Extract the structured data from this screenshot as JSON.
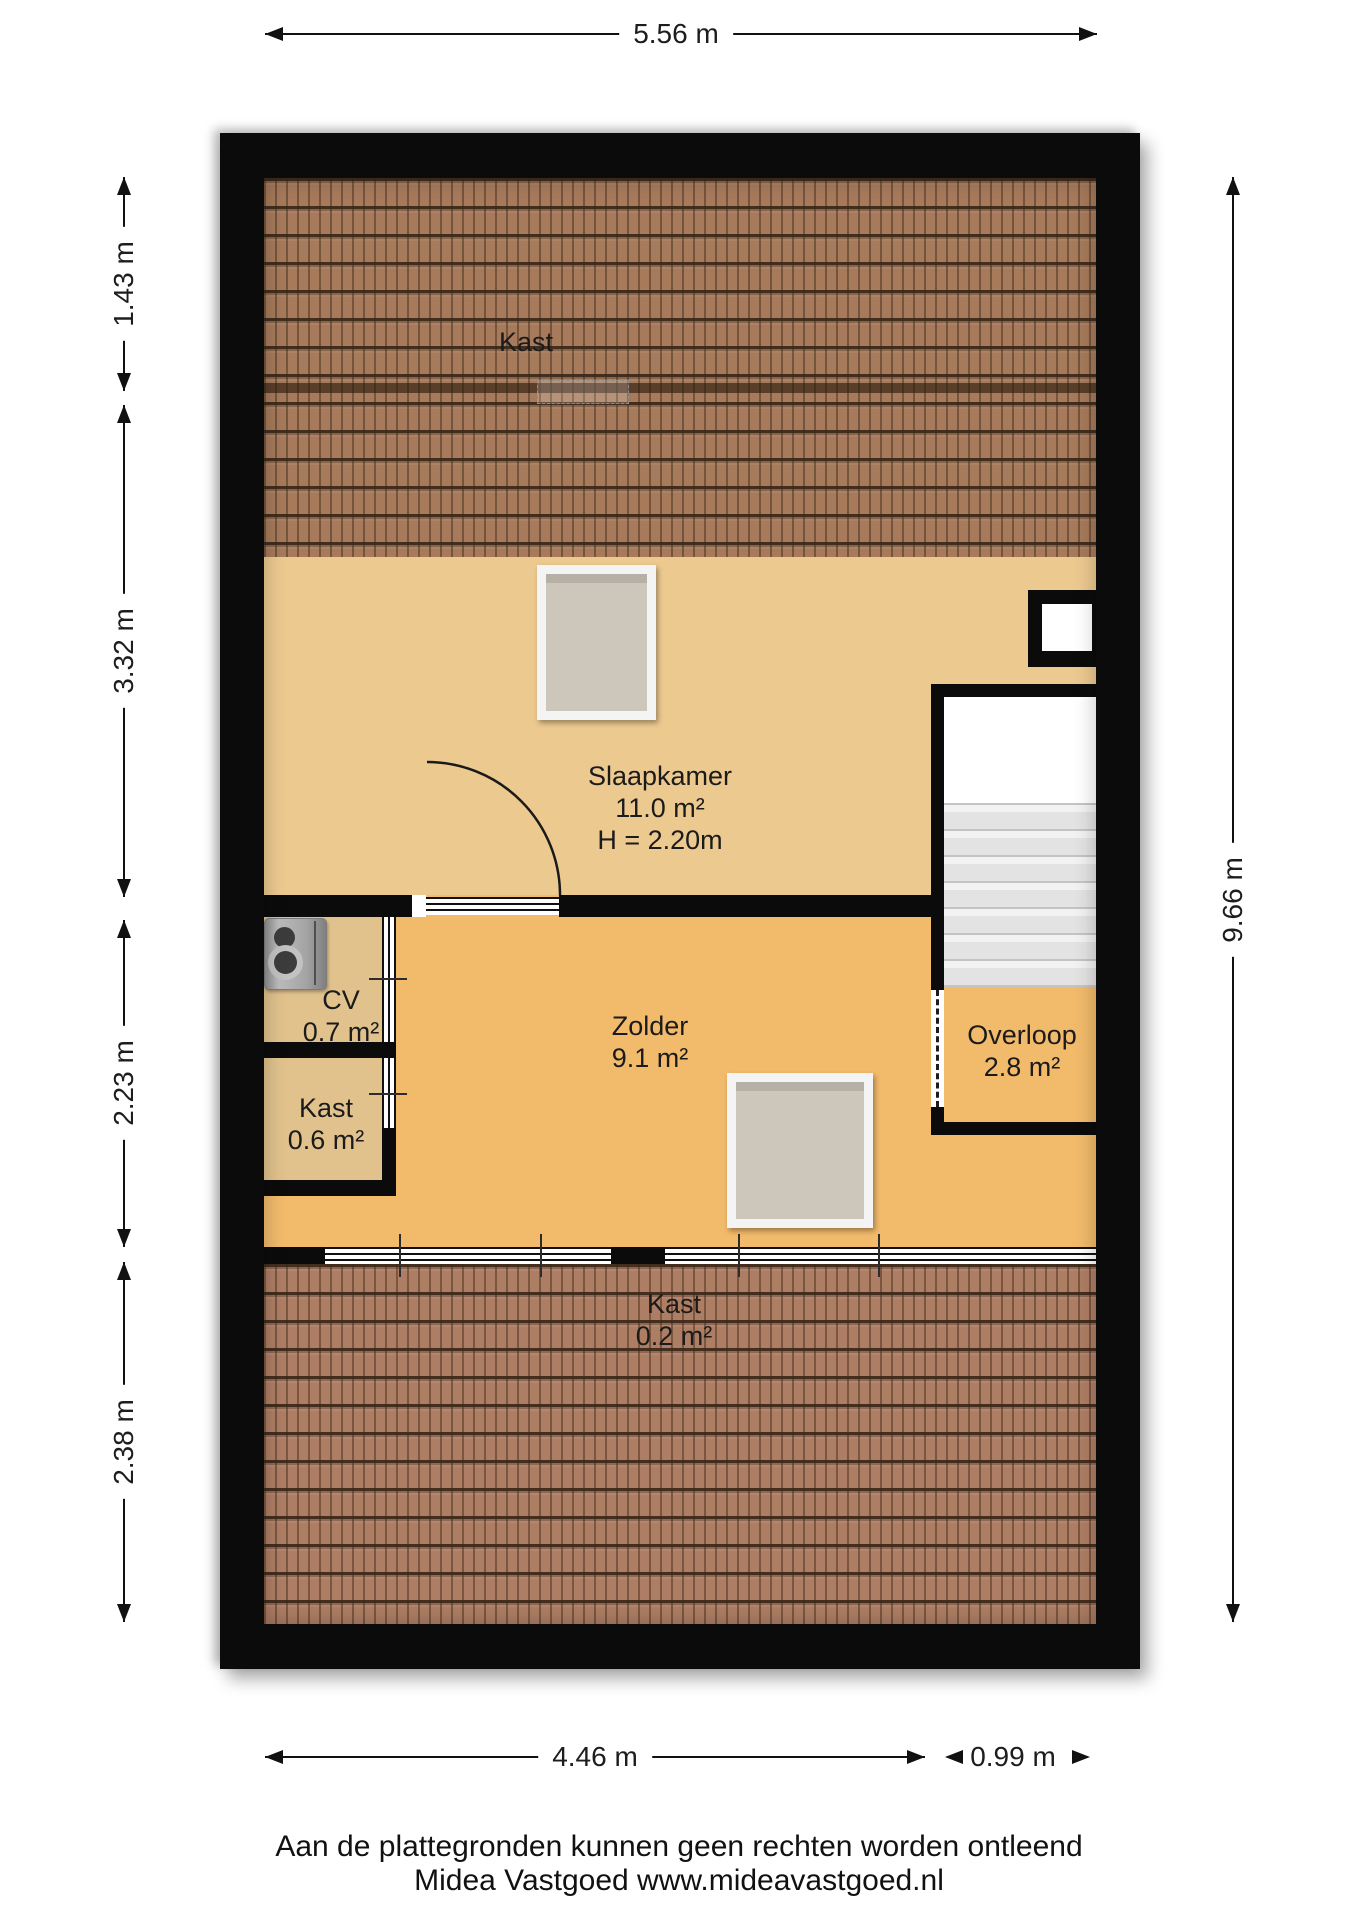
{
  "rooms": {
    "kast_top": {
      "name": "Kast"
    },
    "slaapkamer": {
      "name": "Slaapkamer",
      "area": "11.0 m²",
      "height": "H = 2.20m"
    },
    "cv": {
      "name": "CV",
      "area": "0.7 m²"
    },
    "kast_mid": {
      "name": "Kast",
      "area": "0.6 m²"
    },
    "zolder": {
      "name": "Zolder",
      "area": "9.1 m²"
    },
    "overloop": {
      "name": "Overloop",
      "area": "2.8 m²"
    },
    "kast_bottom": {
      "name": "Kast",
      "area": "0.2 m²"
    }
  },
  "dimensions": {
    "top": "5.56 m",
    "right": "9.66 m",
    "left": [
      "1.43 m",
      "3.32 m",
      "2.23 m",
      "2.38 m"
    ],
    "bottom": [
      "4.46 m",
      "0.99 m"
    ]
  },
  "footer": {
    "disclaimer": "Aan de plattegronden kunnen geen rechten worden ontleend",
    "company": "Midea Vastgoed www.mideavastgoed.nl"
  },
  "colors": {
    "floor_primary": "#f2ba6b",
    "floor_secondary": "#ecc98f",
    "floor_closet": "#e1c28d",
    "roof_top": "#a67a5b",
    "roof_bottom": "#ae7e64",
    "wall": "#0b0b0b"
  }
}
